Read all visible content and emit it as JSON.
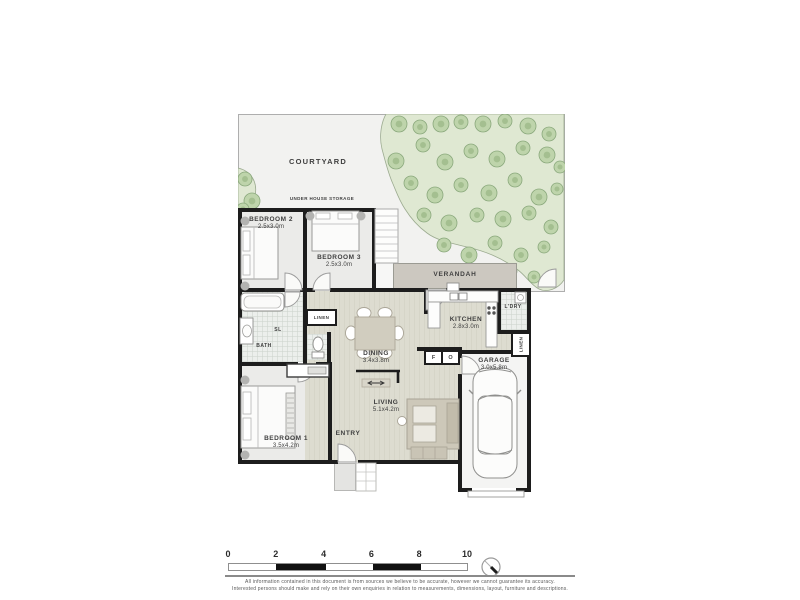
{
  "site": {
    "courtyard_label": "COURTYARD",
    "storage_label": "UNDER HOUSE STORAGE"
  },
  "rooms": {
    "bedroom2": {
      "name": "BEDROOM 2",
      "dims": "2.5x3.0m"
    },
    "bedroom3": {
      "name": "BEDROOM 3",
      "dims": "2.5x3.0m"
    },
    "bedroom1": {
      "name": "BEDROOM 1",
      "dims": "3.5x4.2m"
    },
    "kitchen": {
      "name": "KITCHEN",
      "dims": "2.8x3.0m"
    },
    "dining": {
      "name": "DINING",
      "dims": "3.4x3.8m"
    },
    "living": {
      "name": "LIVING",
      "dims": "5.1x4.2m"
    },
    "garage": {
      "name": "GARAGE",
      "dims": "3.0x5.8m"
    },
    "verandah": {
      "name": "VERANDAH"
    },
    "laundry": {
      "name": "L'DRY"
    },
    "bath": {
      "name": "BATH"
    },
    "skylight": {
      "name": "SL"
    },
    "linen_hall": {
      "name": "LINEN"
    },
    "linen_garage": {
      "name": "LINEN"
    },
    "entry": {
      "name": "ENTRY"
    }
  },
  "appliances": {
    "fridge": "F",
    "oven": "O"
  },
  "trees": [
    [
      161,
      10,
      8
    ],
    [
      182,
      13,
      7
    ],
    [
      203,
      10,
      8
    ],
    [
      223,
      8,
      7
    ],
    [
      245,
      10,
      8
    ],
    [
      267,
      7,
      7
    ],
    [
      290,
      12,
      8
    ],
    [
      311,
      20,
      7
    ],
    [
      158,
      47,
      8
    ],
    [
      185,
      31,
      7
    ],
    [
      207,
      48,
      8
    ],
    [
      233,
      37,
      7
    ],
    [
      259,
      45,
      8
    ],
    [
      285,
      34,
      7
    ],
    [
      309,
      41,
      8
    ],
    [
      322,
      53,
      6
    ],
    [
      173,
      69,
      7
    ],
    [
      197,
      81,
      8
    ],
    [
      223,
      71,
      7
    ],
    [
      251,
      79,
      8
    ],
    [
      277,
      66,
      7
    ],
    [
      301,
      83,
      8
    ],
    [
      319,
      75,
      6
    ],
    [
      186,
      101,
      7
    ],
    [
      211,
      109,
      8
    ],
    [
      239,
      101,
      7
    ],
    [
      265,
      105,
      8
    ],
    [
      291,
      99,
      7
    ],
    [
      313,
      113,
      7
    ],
    [
      206,
      131,
      7
    ],
    [
      231,
      141,
      8
    ],
    [
      257,
      129,
      7
    ],
    [
      283,
      141,
      7
    ],
    [
      306,
      133,
      6
    ],
    [
      249,
      161,
      7
    ],
    [
      273,
      157,
      6
    ],
    [
      296,
      163,
      6
    ],
    [
      7,
      65,
      7
    ],
    [
      14,
      87,
      8
    ],
    [
      5,
      95,
      6
    ]
  ],
  "scale_bar": {
    "ticks": [
      "0",
      "2",
      "4",
      "6",
      "8",
      "10"
    ]
  },
  "disclaimer": {
    "line1": "All information contained in this document is from sources we believe to be accurate, however we cannot guarantee its accuracy.",
    "line2": "Interested persons should make and rely on their own enquiries in relation to measurements, dimensions, layout, furniture and descriptions."
  },
  "colors": {
    "wall": "#1d1d1d",
    "courtyard": "#f2f2f0",
    "garden": "#dfe8d2",
    "tree_fill": "#bed4ab",
    "tree_stroke": "#8aa87c",
    "floorboards": "#dcdcd0",
    "verandah": "#cbc7bf",
    "furniture": "#d1cdbf"
  }
}
